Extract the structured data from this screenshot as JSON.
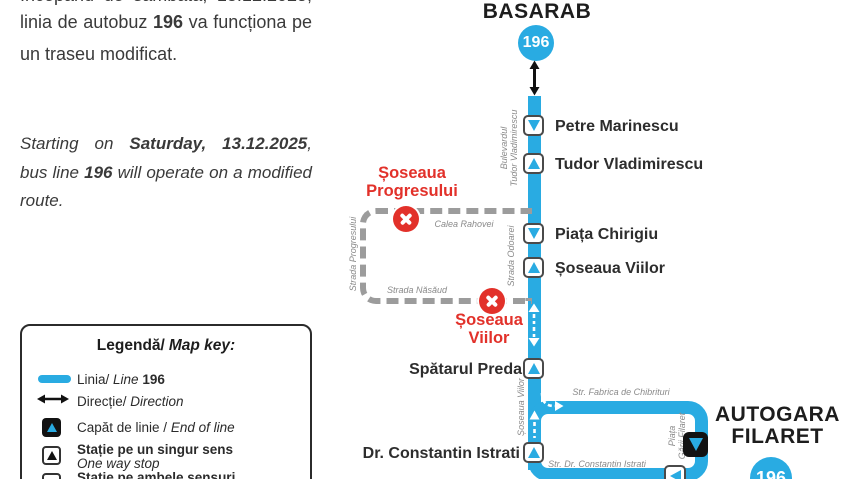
{
  "notice": {
    "ro": {
      "line1": "Începând de sâmbătă, 13.12.2025,",
      "line2_pre": "linia de autobuz ",
      "line2_bold": "196",
      "line2_post": " va funcționa pe",
      "line3": "un traseu modificat."
    },
    "en": {
      "line1_pre": "Starting on ",
      "line1_bold": "Saturday, 13.12.2025",
      "line1_post": ",",
      "line2_pre": "bus line ",
      "line2_bold": "196",
      "line2_post": " will operate on a modified",
      "line3": "route."
    }
  },
  "legend": {
    "title_ro": "Legendă/",
    "title_en": "Map key:",
    "line_item_ro": "Linia/ ",
    "line_item_en": "Line",
    "line_item_num": " 196",
    "direction_ro": "Direcție/ ",
    "direction_en": "Direction",
    "endline_ro": "Capăt de linie / ",
    "endline_en": "End of line",
    "oneway_ro": "Stație pe un singur sens",
    "oneway_en": "One way stop",
    "bothways_ro": "Stație pe ambele sensuri"
  },
  "map": {
    "terminal_top": "BASARAB",
    "badge": "196",
    "stops": [
      {
        "name": "Petre Marinescu"
      },
      {
        "name": "Tudor Vladimirescu"
      },
      {
        "name": "Piața Chirigiu"
      },
      {
        "name": "Șoseaua Viilor"
      },
      {
        "name": "Spătarul Preda"
      },
      {
        "name": "Dr. Constantin Istrati"
      }
    ],
    "terminal_bottom_line1": "AUTOGARA",
    "terminal_bottom_line2": "FILARET",
    "terminal_bottom_badge": "196",
    "closures": [
      {
        "line1": "Șoseaua",
        "line2": "Progresului"
      },
      {
        "line1": "Șoseaua",
        "line2": "Viilor"
      }
    ],
    "streets": {
      "bulevardul_l1": "Bulevardul",
      "bulevardul_l2": "Tudor Vladimirescu",
      "odoarei": "Strada Odoarei",
      "progresului": "Strada Progresului",
      "rahovei": "Calea Rahovei",
      "nasaud": "Strada Năsăud",
      "viilor_vert": "Șoseaua Viilor",
      "fabrica": "Str. Fabrica de Chibrituri",
      "istrati": "Str. Dr. Constantin Istrati",
      "piata_l1": "Piața",
      "piata_l2": "Gării Filaret"
    }
  },
  "colors": {
    "line_blue": "#29ABE2",
    "closure_red": "#E2312A",
    "dash_gray": "#9C9C9C"
  }
}
